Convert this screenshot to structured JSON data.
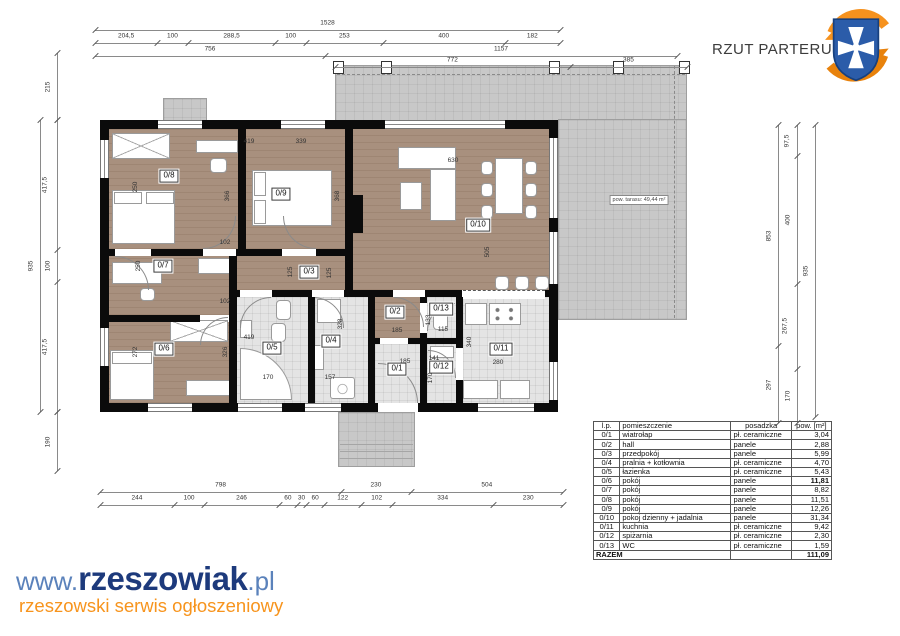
{
  "title": "RZUT PARTERU",
  "watermark": {
    "www": "www.",
    "name": "rzeszowiak",
    "tld": ".pl",
    "tagline": "rzeszowski serwis ogłoszeniowy"
  },
  "plan": {
    "terrace_label": "pow. tarasu: 49,44 m²",
    "room_labels": [
      "0/1",
      "0/2",
      "0/3",
      "0/4",
      "0/5",
      "0/6",
      "0/7",
      "0/8",
      "0/9",
      "0/10",
      "0/11",
      "0/12",
      "0/13"
    ],
    "interior_dims": [
      "419",
      "250",
      "366",
      "339",
      "368",
      "630",
      "505",
      "250",
      "102",
      "102",
      "125",
      "125",
      "272",
      "419",
      "326",
      "170",
      "328",
      "157",
      "185",
      "133",
      "115",
      "185",
      "141",
      "170",
      "340",
      "280"
    ],
    "dim_chains": {
      "top": [
        [
          "1528"
        ],
        [
          "204,5",
          "100",
          "288,5",
          "100",
          "253",
          "400",
          "182"
        ],
        [
          "756",
          "1157"
        ],
        [
          "772",
          "385"
        ]
      ],
      "bottom": [
        [
          "798",
          "230",
          "504"
        ],
        [
          "244",
          "100",
          "246",
          "60",
          "30",
          "60",
          "122",
          "102",
          "334",
          "230"
        ]
      ],
      "left": [
        [
          "935"
        ],
        [
          "417,5",
          "100",
          "417,5"
        ],
        [
          "215"
        ],
        [
          "190"
        ]
      ],
      "right": [
        [
          "853",
          "297"
        ],
        [
          "97,5",
          "400",
          "267,5",
          "170"
        ],
        [
          "935"
        ]
      ]
    }
  },
  "table": {
    "headers": [
      "l.p.",
      "pomieszczenie",
      "posadzka",
      "pow. [m²]"
    ],
    "rows": [
      [
        "0/1",
        "wiatrołap",
        "pł. ceramiczne",
        "3,04"
      ],
      [
        "0/2",
        "hall",
        "panele",
        "2,88"
      ],
      [
        "0/3",
        "przedpokój",
        "panele",
        "5,99"
      ],
      [
        "0/4",
        "pralnia + kotłownia",
        "pł. ceramiczne",
        "4,70"
      ],
      [
        "0/5",
        "łazienka",
        "pł. ceramiczne",
        "5,43"
      ],
      [
        "0/6",
        "pokój",
        "panele",
        "11,81"
      ],
      [
        "0/7",
        "pokój",
        "panele",
        "8,82"
      ],
      [
        "0/8",
        "pokój",
        "panele",
        "11,51"
      ],
      [
        "0/9",
        "pokój",
        "panele",
        "12,26"
      ],
      [
        "0/10",
        "pokoj dzienny + jadalnia",
        "panele",
        "31,34"
      ],
      [
        "0/11",
        "kuchnia",
        "pł. ceramiczne",
        "9,42"
      ],
      [
        "0/12",
        "spiżarnia",
        "pł. ceramiczne",
        "2,30"
      ],
      [
        "0/13",
        "WC",
        "pł. ceramiczne",
        "1,59"
      ]
    ],
    "bold_value_rows": [
      "0/6"
    ],
    "total_label": "RAZEM",
    "total_value": "111,09"
  },
  "colors": {
    "wood_floor": "#a8907e",
    "ceramic_floor": "#e4e4e4",
    "terrace": "#c8c8c8",
    "wall": "#0b0b0b",
    "logo_blue": "#2b5ca9",
    "logo_orange": "#f6921e",
    "brand_navy": "#1d3a7c",
    "brand_blue": "#5b82bb",
    "brand_orange": "#f7941d"
  }
}
